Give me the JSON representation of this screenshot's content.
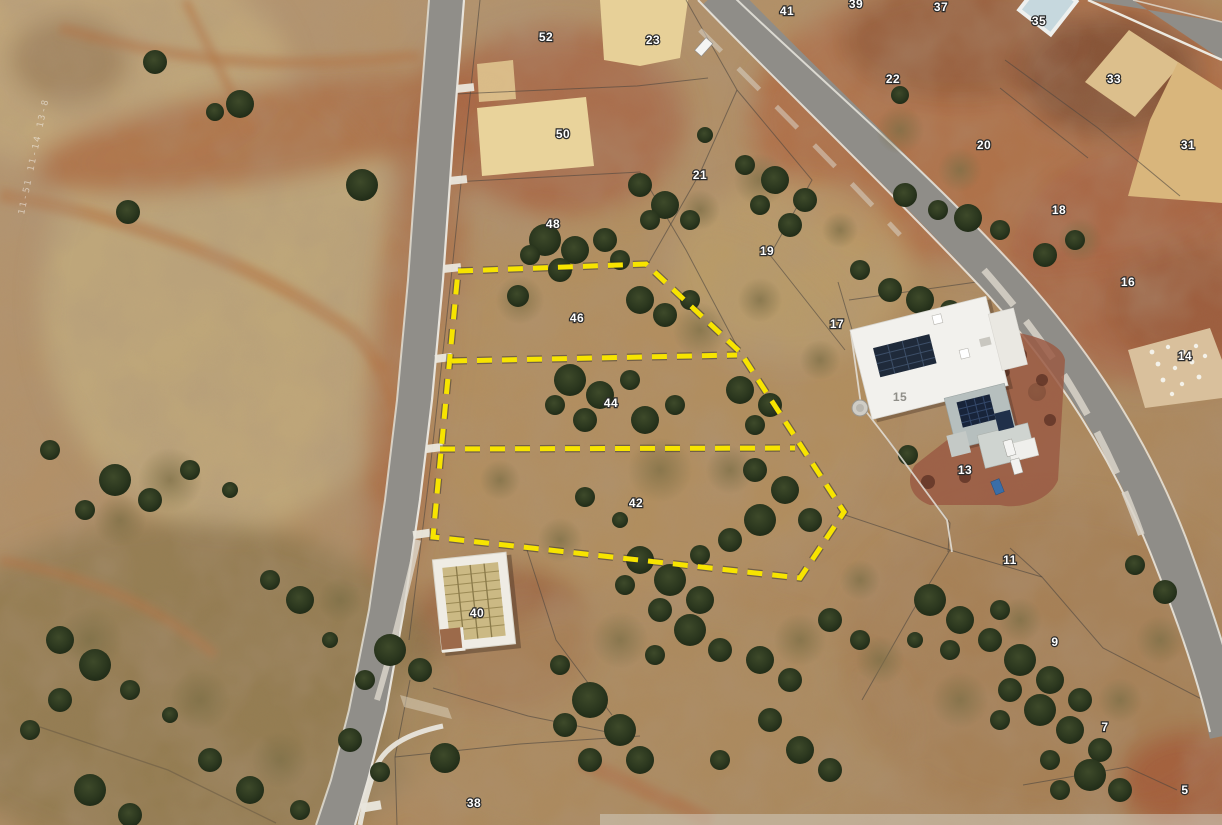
{
  "map": {
    "kind": "aerial-satellite-subdivision-view",
    "watermark": "11-51 11-14 13-8",
    "colors": {
      "highlight_yellow": "#f7e400",
      "label_fill": "#ffffff",
      "label_outline": "#2b2b2b",
      "road_asphalt": "#8f8d88",
      "kerb_white": "#eceae2",
      "sand_pad": "#e7d098",
      "terrain_base": "#b29067"
    },
    "highlight": {
      "color": "#f7e400",
      "highlighted_lots": [
        "46",
        "44",
        "42"
      ],
      "outline": [
        [
          458,
          271
        ],
        [
          646,
          264
        ],
        [
          740,
          352
        ],
        [
          844,
          512
        ],
        [
          800,
          578
        ],
        [
          433,
          537
        ]
      ],
      "dividers": [
        [
          [
            452,
            361
          ],
          [
            737,
            355
          ]
        ],
        [
          [
            440,
            449
          ],
          [
            795,
            448
          ]
        ]
      ]
    },
    "lots": [
      {
        "id": "52",
        "x": 546,
        "y": 41
      },
      {
        "id": "50",
        "x": 563,
        "y": 138
      },
      {
        "id": "48",
        "x": 553,
        "y": 228
      },
      {
        "id": "46",
        "x": 577,
        "y": 322
      },
      {
        "id": "44",
        "x": 611,
        "y": 407
      },
      {
        "id": "42",
        "x": 636,
        "y": 507
      },
      {
        "id": "40",
        "x": 477,
        "y": 617
      },
      {
        "id": "38",
        "x": 474,
        "y": 807
      },
      {
        "id": "23",
        "x": 653,
        "y": 44
      },
      {
        "id": "21",
        "x": 700,
        "y": 179
      },
      {
        "id": "19",
        "x": 767,
        "y": 255
      },
      {
        "id": "17",
        "x": 837,
        "y": 328
      },
      {
        "id": "15",
        "x": 900,
        "y": 401,
        "variant": "plain"
      },
      {
        "id": "13",
        "x": 965,
        "y": 474
      },
      {
        "id": "11",
        "x": 1010,
        "y": 564
      },
      {
        "id": "9",
        "x": 1055,
        "y": 646
      },
      {
        "id": "7",
        "x": 1105,
        "y": 731
      },
      {
        "id": "5",
        "x": 1185,
        "y": 794
      },
      {
        "id": "41",
        "x": 787,
        "y": 15
      },
      {
        "id": "39",
        "x": 856,
        "y": 8
      },
      {
        "id": "37",
        "x": 941,
        "y": 11
      },
      {
        "id": "35",
        "x": 1039,
        "y": 25
      },
      {
        "id": "33",
        "x": 1114,
        "y": 83
      },
      {
        "id": "31",
        "x": 1188,
        "y": 149
      },
      {
        "id": "22",
        "x": 893,
        "y": 83
      },
      {
        "id": "20",
        "x": 984,
        "y": 149
      },
      {
        "id": "18",
        "x": 1059,
        "y": 214
      },
      {
        "id": "16",
        "x": 1128,
        "y": 286
      },
      {
        "id": "14",
        "x": 1185,
        "y": 360
      }
    ]
  }
}
